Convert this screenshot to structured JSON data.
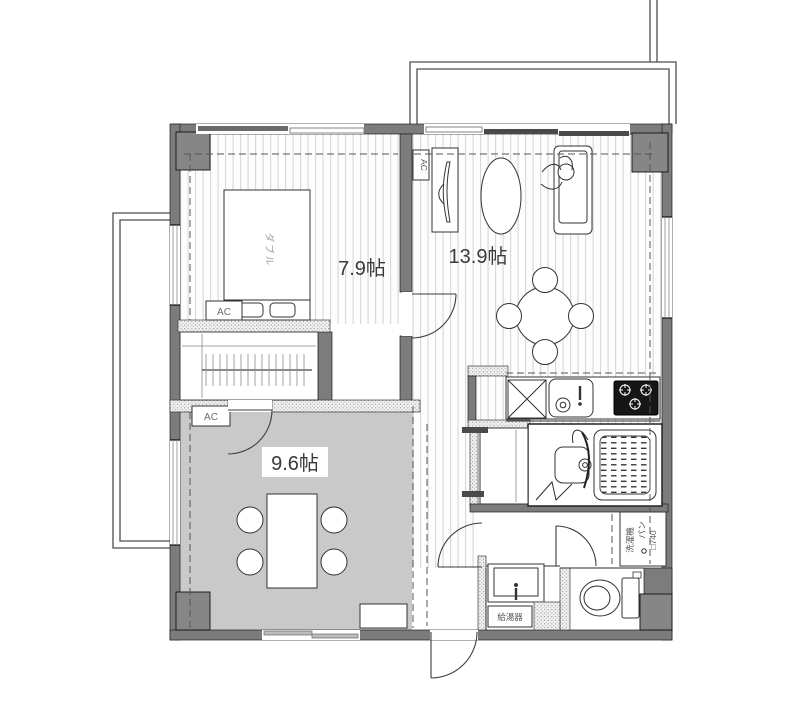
{
  "plan": {
    "type": "apartment-floor-plan",
    "rooms": {
      "bedroom": {
        "size_label": "7.9帖"
      },
      "living": {
        "size_label": "13.9帖"
      },
      "dining": {
        "size_label": "9.6帖"
      }
    },
    "labels": {
      "bed": "ダブル",
      "ac_bedroom": "AC",
      "ac_living": "AC",
      "ac_dining": "AC",
      "washer_line1": "洗濯機",
      "washer_line2": "パン",
      "washer_line3": "□740",
      "water_heater": "給湯器"
    },
    "colors": {
      "wall": "#7c7c7c",
      "pillar": "#868686",
      "dining_floor": "#c9c9c9",
      "floor_stripe": "#d7d7d7",
      "stove": "#161616",
      "line": "#2e2e2e"
    }
  }
}
